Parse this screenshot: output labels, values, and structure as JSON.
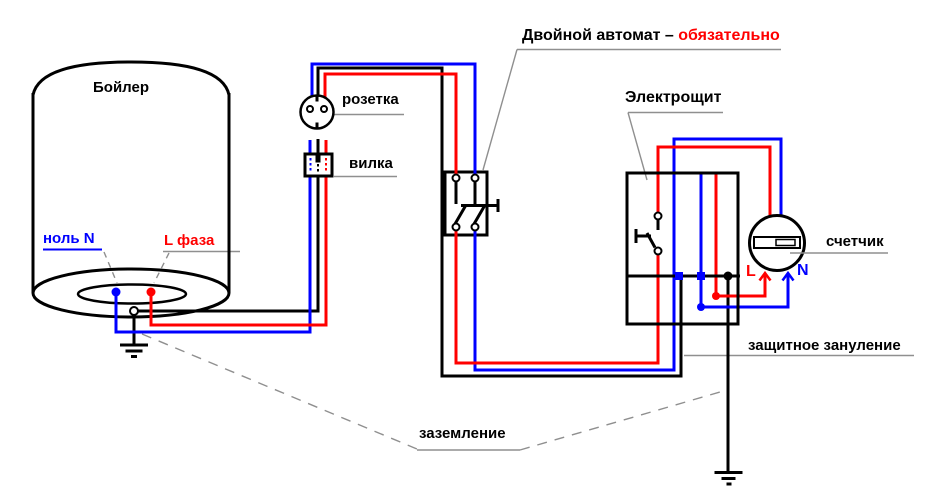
{
  "note_breaker": {
    "text_black": "Двойной автомат – ",
    "text_red": "обязательно"
  },
  "boiler": {
    "label": "Бойлер",
    "neutral_terminal_label": "ноль N",
    "phase_terminal_label": "L фаза"
  },
  "socket": {
    "label": "розетка"
  },
  "plug": {
    "label": "вилка"
  },
  "panel": {
    "label": "Электрощит"
  },
  "meter": {
    "label": "счетчик",
    "phase_in_label": "L",
    "neutral_in_label": "N"
  },
  "grounding": {
    "protective_label": "защитное зануление",
    "earth_label": "заземление"
  },
  "colors": {
    "phase": "#ff0000",
    "neutral": "#0000ff",
    "ground": "#000000",
    "leader": "#8f8f8f",
    "background": "#ffffff"
  }
}
